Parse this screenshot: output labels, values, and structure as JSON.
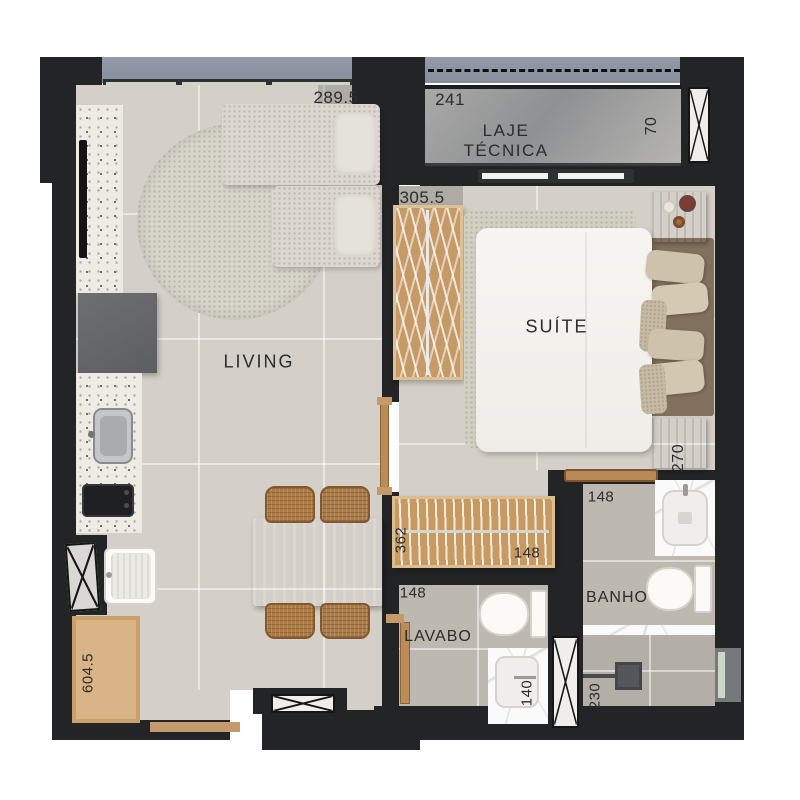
{
  "rooms": {
    "living": "LIVING",
    "suite": "SUÍTE",
    "laje_line1": "LAJE",
    "laje_line2": "TÉCNICA",
    "banho": "BANHO",
    "lavabo": "LAVABO"
  },
  "dimensions": {
    "living_width": "289.5",
    "laje_width": "241",
    "laje_depth": "70",
    "suite_width": "305.5",
    "nightstand_depth": "270",
    "bench_length": "362",
    "bench_depth": "148",
    "lavabo_width": "148",
    "banho_width": "148",
    "lavabo_counter": "140",
    "shower_width": "230",
    "kitchen_run": "604.5"
  },
  "icons": {
    "shaft_symbol": "x-cross",
    "count_shafts": 4
  },
  "colors": {
    "wall": "#232426",
    "floor_dry": "#d4d0c9",
    "floor_wet": "#bdb8b0",
    "wood": "#b98a55",
    "terrazzo": "#edebe4",
    "balcony_slab": "#8e96a3",
    "laje_slab": "#9c9c9b",
    "marble": "#fafafa",
    "label_text": "#2c2c2c"
  }
}
